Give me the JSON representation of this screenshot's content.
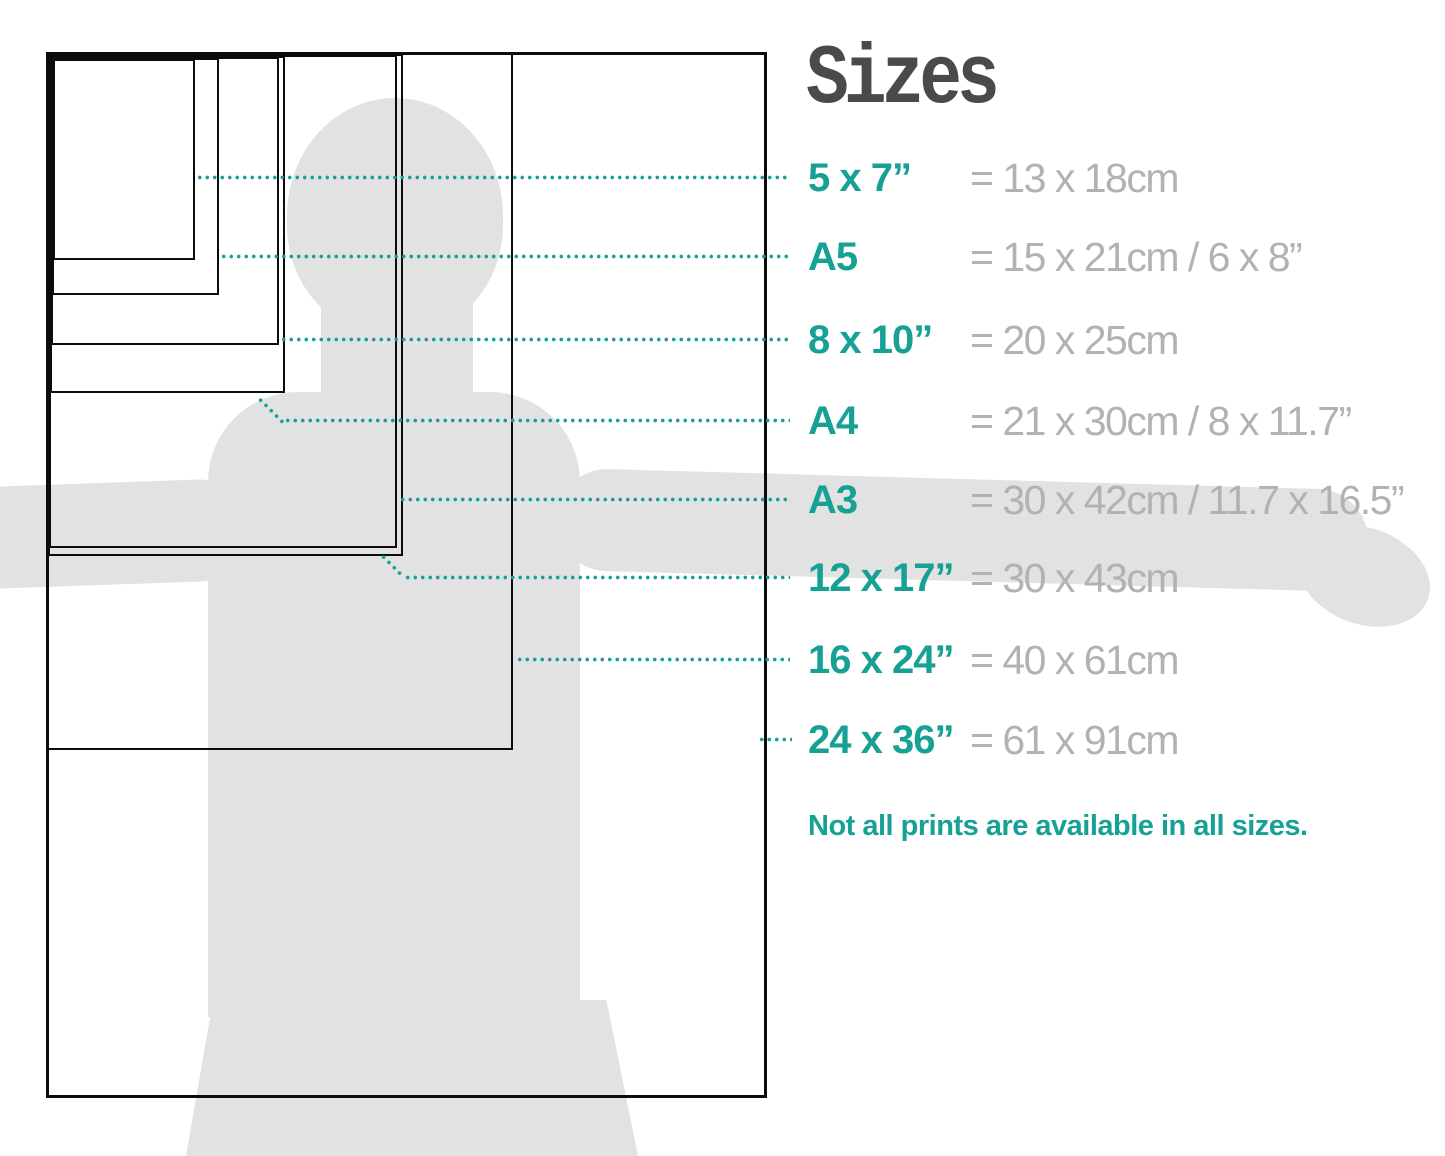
{
  "title": "Sizes",
  "note": "Not all prints are available in all sizes.",
  "colors": {
    "accent_teal": "#17a195",
    "value_gray": "#b2b2b2",
    "title_gray": "#4a4a4a",
    "silhouette_gray": "#e2e2e2",
    "outline_black": "#0c0c0c"
  },
  "sizes": [
    {
      "id": "5x7",
      "label": "5 x 7”",
      "value": "= 13 x 18cm"
    },
    {
      "id": "a5",
      "label": "A5",
      "value": "= 15 x 21cm / 6 x 8”"
    },
    {
      "id": "8x10",
      "label": "8 x 10”",
      "value": "= 20 x 25cm"
    },
    {
      "id": "a4",
      "label": "A4",
      "value": "= 21 x 30cm / 8 x 11.7”"
    },
    {
      "id": "a3",
      "label": "A3",
      "value": "= 30 x 42cm / 11.7 x 16.5”"
    },
    {
      "id": "12x17",
      "label": "12 x 17”",
      "value": "= 30 x 43cm"
    },
    {
      "id": "16x24",
      "label": "16 x 24”",
      "value": "= 40 x 61cm"
    },
    {
      "id": "24x36",
      "label": "24 x 36”",
      "value": "= 61 x 91cm"
    }
  ]
}
